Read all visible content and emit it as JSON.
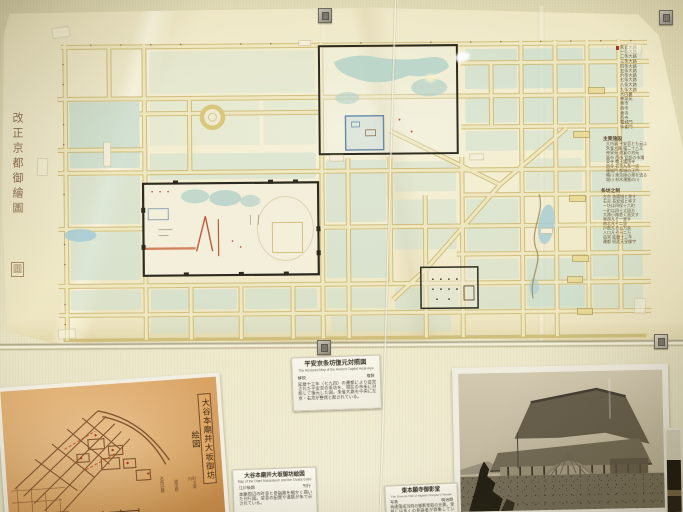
{
  "main_map": {
    "calligraphy_title": "改正京都御繪圖",
    "seal": "圖",
    "legend_top": [
      "朱雀大路",
      "一条大路",
      "二条大路",
      "三条大路",
      "四条大路",
      "五条大路",
      "六条大路",
      "七条大路",
      "八条大路",
      "九条大路",
      "大内裏",
      "神泉苑",
      "東市",
      "西市",
      "東寺",
      "西寺",
      "羅城門",
      "朱雀門"
    ],
    "legend_mid_header": "主要施設",
    "legend_mid": [
      "大内裏 平安宮とも云ふ",
      "朱雀大路 幅二十八丈",
      "神泉苑 遊宴の池苑",
      "東市 西市 官設の市場",
      "東寺 教王護国寺",
      "西寺 右京九条一坊",
      "羅城門 都城の正門",
      "鴨川 東京極の東を流る",
      "堀川 材木運搬の川"
    ],
    "legend_bottom_header": "条坊之制",
    "legend_bottom": [
      "左京 洛陽城と称す",
      "右京 長安城と称す",
      "一坊は四保十六町",
      "一町は四十丈四方",
      "大路小路悉く直交す",
      "東西凡そ一里半",
      "南北凡そ二里",
      "戸数凡そ五万余",
      "人口凡そ十二万",
      "造営 延暦十三年",
      "遷都 桓武天皇御宇"
    ],
    "road_tags": [
      "一条",
      "二条",
      "三条",
      "四条",
      "五条",
      "六条"
    ]
  },
  "cards": {
    "main_map_card": {
      "title": "平安京条坊復元対照図",
      "subtitle": "The Restored Map of the Ancient Capital Heian-kyo",
      "meta_left": "解説",
      "meta_right": "複製",
      "body": "延暦十三年（七九四）の遷都により造営された平安京の条坊を、現在の市街に対照して復元した図。朱雀大路を中央に左京・右京が整然と配されている。"
    },
    "sepia_map_card": {
      "title": "大谷本廟并大坂御坊絵図",
      "subtitle": "Map of the Otani Mausoleum and the Osaka Gobo",
      "meta_left": "江戸後期",
      "meta_right": "刊行",
      "body": "本廟周辺の町並と参詣路を細かく描いた刊行図。堂舎の配置や道筋が朱で示されている。"
    },
    "temple_photo_card": {
      "title": "東本願寺御影堂",
      "subtitle": "The Goei-do Hall of Higashi Hongan-ji Temple",
      "meta_left": "写真",
      "meta_right": "明治期",
      "body": "再建落成当時の御影堂前の光景。堂前には多くの参詣者が群集している。"
    }
  },
  "sepia_map": {
    "cartouche": "大谷本廟并大坂御坊絵図",
    "scale_caption": "縮尺六千分一",
    "side_note_1": "名所旧跡",
    "side_note_2": "道法附",
    "side_note_3": "町々案内"
  },
  "colors": {
    "wall": "#e2dbb6",
    "paper": "#f0e9c8",
    "block_teal": "#c9ddd0",
    "street_yellow": "#e7da9e",
    "ink_black": "#2e2c20",
    "accent_red": "#bf5a38",
    "water_blue": "#a9cdd4",
    "sepia_orange": "#d8a263",
    "card_white": "#f8f5ea"
  }
}
